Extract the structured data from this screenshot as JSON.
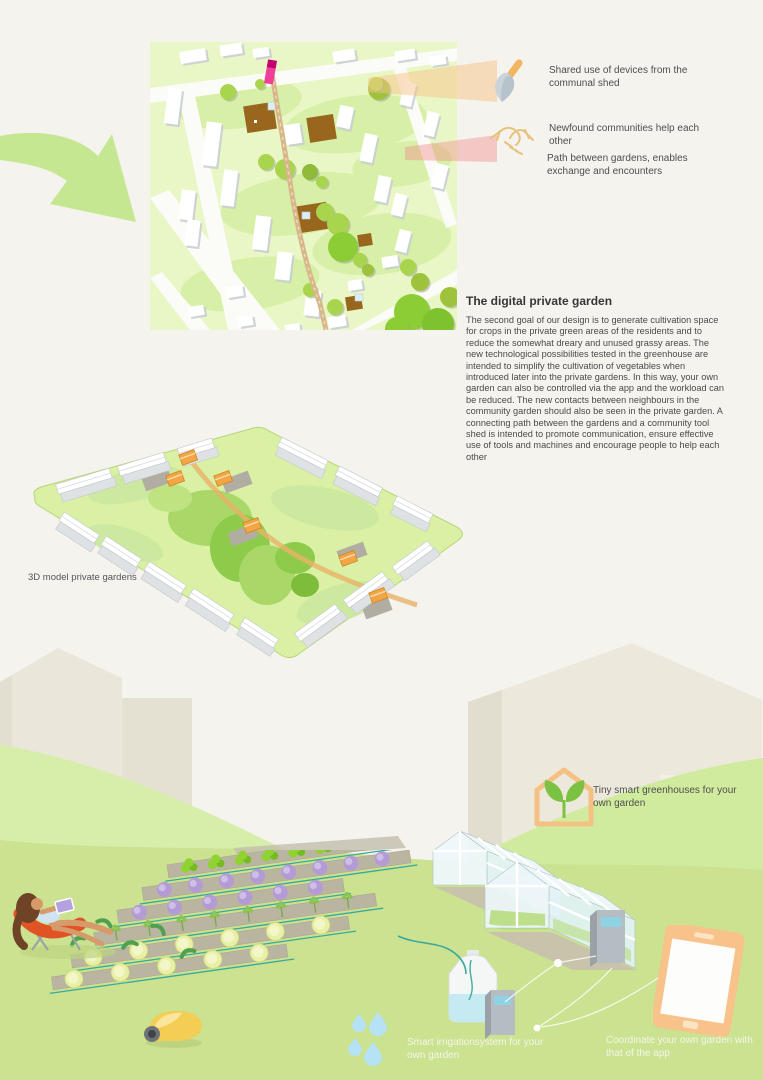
{
  "legend": [
    {
      "icon": "trowel-icon",
      "text": "Shared use of devices from the communal shed"
    },
    {
      "icon": "handshake-icon",
      "text": "Newfound communities help each other"
    },
    {
      "icon": null,
      "text": "Path between gardens, enables exchange and encounters"
    }
  ],
  "article": {
    "title": "The digital private garden",
    "body": "The second goal of our design is to generate cultivation space for crops in the private green areas of the residents and to reduce the somewhat dreary and unused grassy areas. The new technological possibilities tested in the greenhouse are intended to simplify the cultivation of vegetables when introduced later into the private gardens. In this way, your own garden can also be controlled via the app and the workload can be reduced. The new contacts between neighbours in the community garden should also be seen in the private garden. A connecting path between the gardens and a community tool shed is intended to promote communication, ensure effective use of tools and machines and encourage people to help each other"
  },
  "model": {
    "label": "3D model private gardens"
  },
  "features": {
    "greenhouses": "Tiny smart greenhouses for your own garden",
    "irrigation": "Smart irrigationsystem for your own garden",
    "app": "Coordinate your own garden with that of the app"
  },
  "colors": {
    "page_background": "#f4f3ee",
    "arrow_green": "#c6e792",
    "map_green": "#e9f6c6",
    "path_tan": "#d7b78a",
    "marker_magenta": "#ef3f96",
    "beam_orange": "#f7c488",
    "beam_pink": "#f2928e",
    "icon_outline_orange": "#f5c084",
    "sprout_green": "#7cc242",
    "ground_green": "#cbe290",
    "device_screen_blue": "#8fd2e4",
    "drop_blue": "#b5e2f4",
    "phone_orange": "#f7c38b"
  }
}
